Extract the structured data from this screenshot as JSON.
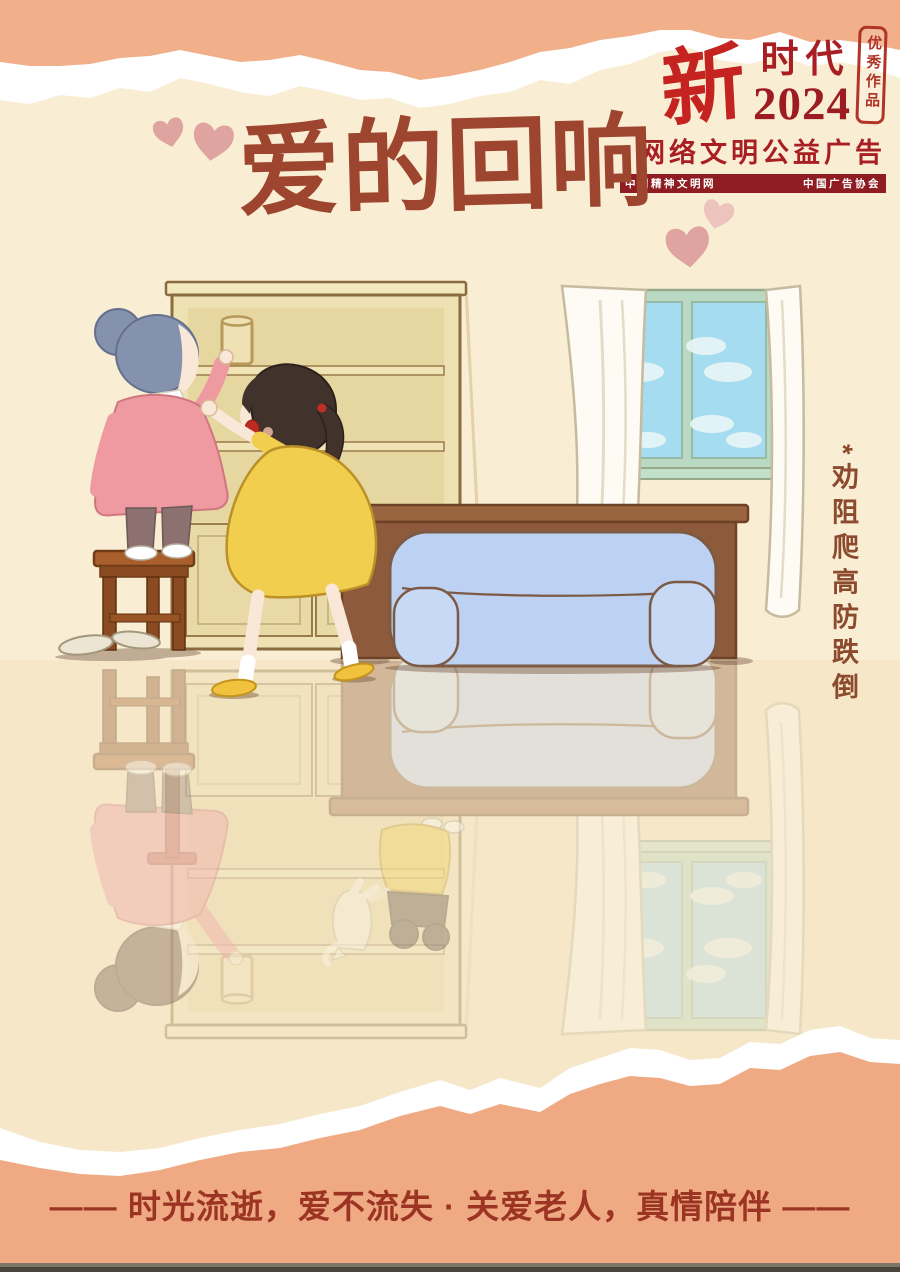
{
  "badge": {
    "brand_char": "新",
    "brand_word": "时代",
    "year": "2024",
    "seal": "优秀作品",
    "campaign": "网络文明公益广告",
    "org_left": "中国精神文明网",
    "org_right": "中国广告协会"
  },
  "title": "爱的回响",
  "side_note": "*劝阻爬高防跌倒",
  "slogan": "—— 时光流逝，爱不流失 · 关爱老人，真情陪伴 ——",
  "colors": {
    "background_cream": "#f9eed4",
    "floor_cream": "#f3e4c4",
    "torn_strip_salmon": "#f1b08a",
    "title_brown_red": "#9e4530",
    "logo_bright_red": "#c5231f",
    "logo_dark_red": "#a81e23",
    "org_bar_red": "#8e1c20",
    "side_note_brown": "#8c4a2e",
    "slogan_red": "#9c3423",
    "heart_pink": "#dfa3a0",
    "sofa_blue": "#bdd1f3",
    "dress_yellow": "#f1ce4d",
    "sweater_pink": "#ef9aa1",
    "grandma_hair_gray": "#8492ae",
    "shelf_tan": "#eee1b3",
    "window_sky_blue": "#a6dcf0"
  }
}
